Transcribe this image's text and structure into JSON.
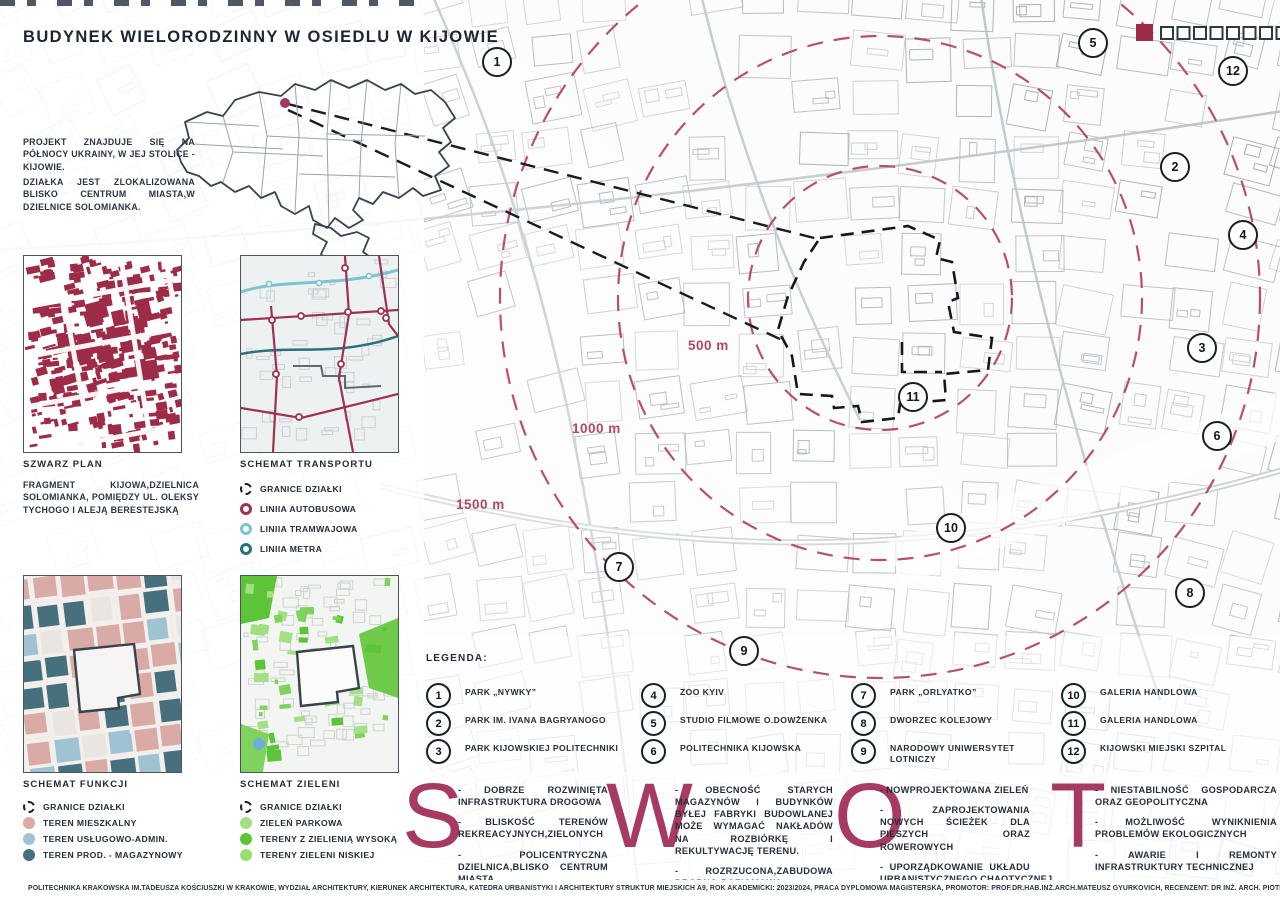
{
  "title": "BUDYNEK WIELORODZINNY W OSIEDLU W KIJOWIE",
  "intro": {
    "p1": "PROJEKT ZNAJDUJE SIĘ NA PÓŁNOCY UKRAINY, W JEJ STOLICE - KIJOWIE.",
    "p2": "DZIAŁKA JEST ZLOKALIZOWANA BLISKO CENTRUM MIASTA,W DZIELNICE SOLOMIANKA."
  },
  "panels": {
    "szwarz": {
      "title": "SZWARZ PLAN",
      "desc": "FRAGMENT KIJOWA,DZIELNICA SOLOMIANKA, POMIĘDZY UL. OLEKSY TYCHOGO I ALEJĄ BERESTEJSKĄ"
    },
    "transport": {
      "title": "SCHEMAT TRANSPORTU",
      "items": [
        {
          "icon": "dashed-circle-icon",
          "type": "dashed",
          "label": "GRANICE DZIAŁKI"
        },
        {
          "icon": "bus-line-icon",
          "type": "ring",
          "color": "#9e3050",
          "label": "LINIIA AUTOBUSOWA"
        },
        {
          "icon": "tram-line-icon",
          "type": "ring",
          "color": "#7cc5d0",
          "label": "LINIIA TRAMWAJOWA"
        },
        {
          "icon": "metro-line-icon",
          "type": "ring",
          "color": "#2e6f7d",
          "label": "LINIIA METRA"
        }
      ]
    },
    "funkcje": {
      "title": "SCHEMAT FUNKCJI",
      "items": [
        {
          "icon": "dashed-circle-icon",
          "type": "dashed",
          "label": "GRANICE DZIAŁKI"
        },
        {
          "icon": "residential-dot-icon",
          "type": "dot",
          "color": "#d9aaa6",
          "label": "TEREN MIESZKALNY"
        },
        {
          "icon": "services-dot-icon",
          "type": "dot",
          "color": "#9fc3d2",
          "label": "TEREN USŁUGOWO-ADMIN."
        },
        {
          "icon": "industrial-dot-icon",
          "type": "dot",
          "color": "#47707f",
          "label": "TEREN PROD. - MAGAZYNOWY"
        }
      ]
    },
    "zielen": {
      "title": "SCHEMAT ZIELENI",
      "items": [
        {
          "icon": "dashed-circle-icon",
          "type": "dashed",
          "label": "GRANICE DZIAŁKI"
        },
        {
          "icon": "park-green-dot-icon",
          "type": "dot",
          "color": "#a2df85",
          "label": "ZIELEŃ PARKOWA"
        },
        {
          "icon": "high-green-dot-icon",
          "type": "dot",
          "color": "#5cc436",
          "label": "TERENY Z ZIELIENIĄ WYSOKĄ"
        },
        {
          "icon": "low-green-dot-icon",
          "type": "dot",
          "color": "#97e06f",
          "label": "TERENY ZIELENI NISKIEJ"
        }
      ]
    }
  },
  "map": {
    "distance_labels": [
      {
        "text": "500 m",
        "x": 688,
        "y": 338
      },
      {
        "text": "1000 m",
        "x": 572,
        "y": 421
      },
      {
        "text": "1500 m",
        "x": 456,
        "y": 497
      }
    ],
    "markers": [
      {
        "n": "1",
        "x": 497,
        "y": 62
      },
      {
        "n": "2",
        "x": 1175,
        "y": 167
      },
      {
        "n": "3",
        "x": 1202,
        "y": 348
      },
      {
        "n": "4",
        "x": 1243,
        "y": 235
      },
      {
        "n": "5",
        "x": 1093,
        "y": 43
      },
      {
        "n": "6",
        "x": 1217,
        "y": 436
      },
      {
        "n": "7",
        "x": 619,
        "y": 567
      },
      {
        "n": "8",
        "x": 1190,
        "y": 593
      },
      {
        "n": "9",
        "x": 744,
        "y": 651
      },
      {
        "n": "10",
        "x": 951,
        "y": 528
      },
      {
        "n": "11",
        "x": 913,
        "y": 397
      },
      {
        "n": "12",
        "x": 1233,
        "y": 71
      }
    ]
  },
  "legenda": {
    "heading": "LEGENDA:",
    "items": [
      {
        "n": "1",
        "label": "PARK „NYWKY”"
      },
      {
        "n": "2",
        "label": "PARK IM. IVANA BAGRYANOGO"
      },
      {
        "n": "3",
        "label": "PARK KIJOWSKIEJ POLITECHNIKI"
      },
      {
        "n": "4",
        "label": "ZOO KYIV"
      },
      {
        "n": "5",
        "label": "STUDIO FILMOWE O.DOWŻENKA"
      },
      {
        "n": "6",
        "label": "POLITECHNIKA KIJOWSKA"
      },
      {
        "n": "7",
        "label": "PARK „ORLYATKO”"
      },
      {
        "n": "8",
        "label": "DWORZEC KOLEJOWY"
      },
      {
        "n": "9",
        "label": "NARODOWY UNIWERSYTET LOTNICZY"
      },
      {
        "n": "10",
        "label": "GALERIA HANDLOWA"
      },
      {
        "n": "11",
        "label": "GALERIA HANDLOWA"
      },
      {
        "n": "12",
        "label": "KIJOWSKI MIEJSKI SZPITAL"
      }
    ]
  },
  "swot": {
    "letters": [
      "S",
      "W",
      "O",
      "T"
    ],
    "strengths": [
      "- DOBRZE ROZWINIĘTA INFRASTRUKTURA DROGOWA",
      "- BLISKOŚĆ TERENÓW REKREACYJNYCH,ZIELONYCH",
      "- POLICENTRYCZNA DZIELNICA,BLISKO CENTRUM MIASTA"
    ],
    "weaknesses": [
      "- OBECNOŚĆ STARYCH MAGAZYNÓW I BUDYNKÓW BYŁEJ FABRYKI BUDOWLANEJ MOŻE WYMAGAĆ NAKŁADÓW NA ROZBIÓRKĘ I REKULTYWACJĘ TERENU.",
      "- ROZRZUCONA,ZABUDOWA DROBNO-POZIOMOWA"
    ],
    "opportunities": [
      "- NOWPROJEKTOWANA ZIELEŃ",
      "- ZAPROJEKTOWANIA NOWYCH ŚCIEŻEK DLA PIESZYCH ORAZ ROWEROWYCH",
      "- UPORZĄDKOWANIE UKŁADU URBANISTYCZNEGO,CHAOTYCZNEJ ZABUDOWY"
    ],
    "threats": [
      "- NIESTABILNOŚĆ GOSPODARCZA ORAZ GEOPOLITYCZNA",
      "- MOŻLIWOŚĆ WYNIKNIENIA PROBLEMÓW EKOLOGICZNYCH",
      "- AWARIE I REMONTY INFRASTRUKTURY TECHNICZNEJ"
    ]
  },
  "footer": "POLITECHNIKA KRAKOWSKA IM.TADEUSZA KOŚCIUSZKI W KRAKOWIE, WYDZIAŁ ARCHITEKTURY, KIERUNEK ARCHITEKTURA, KATEDRA URBANISTYKI I ARCHITEKTURY STRUKTUR MIEJSKICH A9, ROK AKADEMICKI: 2023/2024, PRACA DYPLOMOWA MAGISTERSKA, PROMOTOR: PROF.DR.HAB.INŻ.ARCH.MATEUSZ GYURKOVICH, RECENZENT: DR INŻ. ARCH. PIOTR LANGER AUTOR: INŻ. ARCH.SOFIA SKARZHENKO",
  "colors": {
    "accent_crimson": "#a73a63",
    "marker_red": "#9e2b47",
    "distance_label": "#b5485f",
    "map_line_gray": "#9aa4ab",
    "text_dark": "#232c38"
  }
}
